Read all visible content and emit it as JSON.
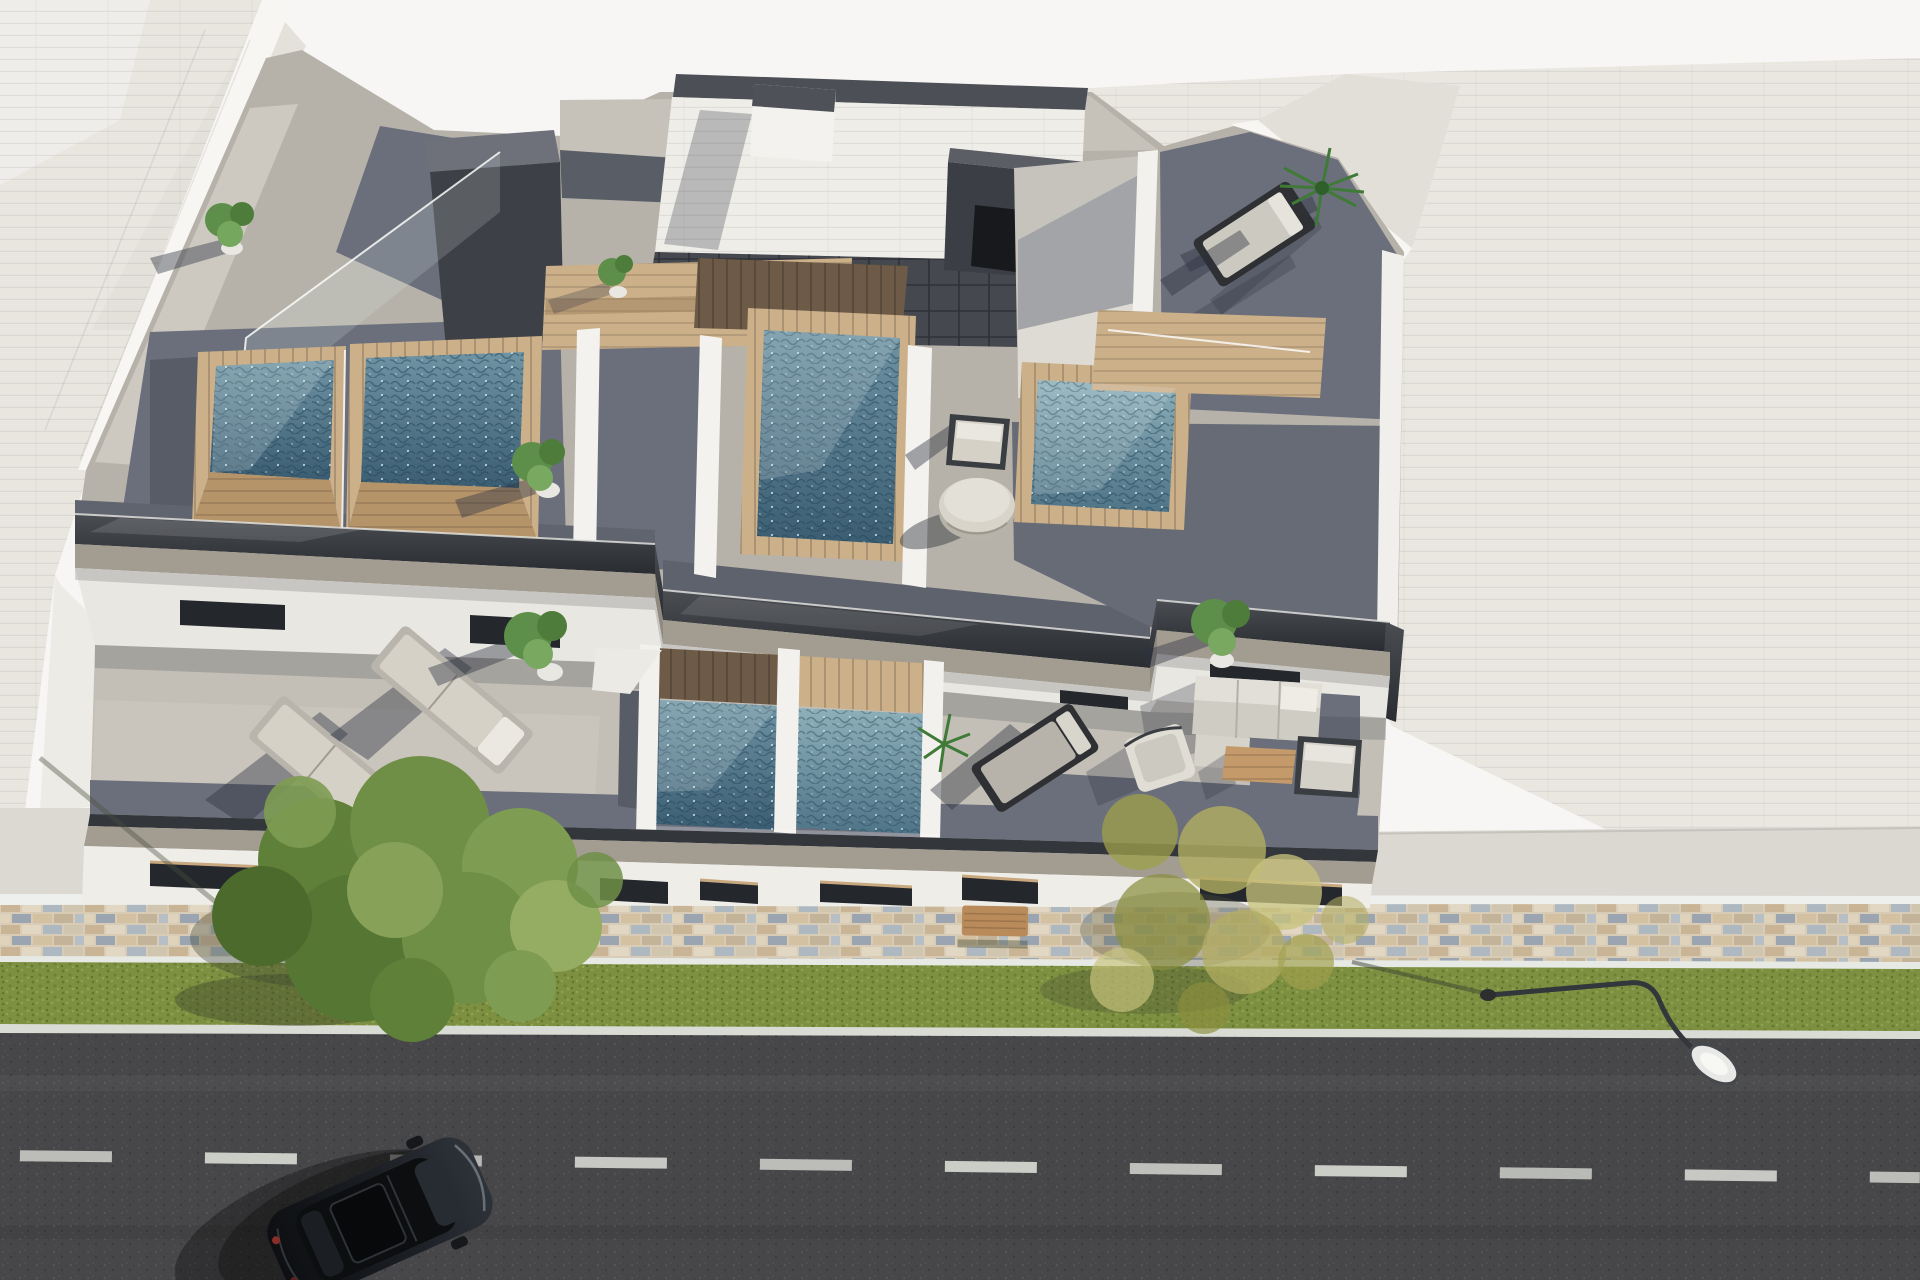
{
  "scene": {
    "type": "3d-architectural-render",
    "view": "aerial top-down perspective",
    "description": "New-build modern residential block with four rooftop plunge pools on the solarium level, a lower terrace level with two more plunge pools and outdoor lounge furniture, flanked by pale neighbouring rooftops, with a mosaic paved sidewalk, grass verge, street lamp, and an asphalt road with a parked black car."
  },
  "colors": {
    "sky": "#f7f6f4",
    "neighbor_roof_left": "#e9e6e0",
    "neighbor_roof_right": "#eae7e1",
    "neighbor_wall_white": "#f7f6f2",
    "apron": "#dbd8d1",
    "roof_paving": "#b6b2aa",
    "roof_paving_sunlit": "#cdc9c1",
    "paving_dark": "#6b6f7b",
    "paving_shadow": "#585c66",
    "parapet_dark": "#33363b",
    "fascia_tan": "#a29c91",
    "wall_white": "#efede8",
    "glazing_dark": "#24272c",
    "stair_tile_dark": "#45484e",
    "stair_top": "#6e717a",
    "wood_light": "#ccb08a",
    "wood_mid": "#b5946a",
    "wood_dark": "#6d5a47",
    "wood_lintel": "#c8a87e",
    "water_light": "#7fa6b2",
    "water_deep": "#3f647a",
    "mosaic_base": "#d8ccb7",
    "curb_white": "#e7e9e4",
    "grass": "#7d9041",
    "asphalt": "#474749",
    "road_marking": "#d9dbd5",
    "car_black": "#15171a",
    "plant_green": "#5d8f4a",
    "palm_green": "#3f7a38",
    "tree_green": "#6f8f46",
    "tree_yellow": "#b2ad62",
    "cushion_light": "#d5d1c7",
    "frame_dark": "#2e3033",
    "table_wood": "#c49a6a",
    "ottoman": "#d8d4ca",
    "bench_wood": "#b98a5a",
    "lamp_metal": "#33363a"
  },
  "objects": {
    "rooftop_pools": 4,
    "lower_terrace_pools": 2,
    "sun_loungers": 4,
    "lounge_sofa_sets": 1,
    "round_ottoman_tables": 1,
    "roof_chairs": 1,
    "potted_plants": 8,
    "street_trees": 2,
    "street_lamps": 1,
    "benches": 1,
    "parked_cars": 1,
    "stair_bulkheads": 2
  }
}
